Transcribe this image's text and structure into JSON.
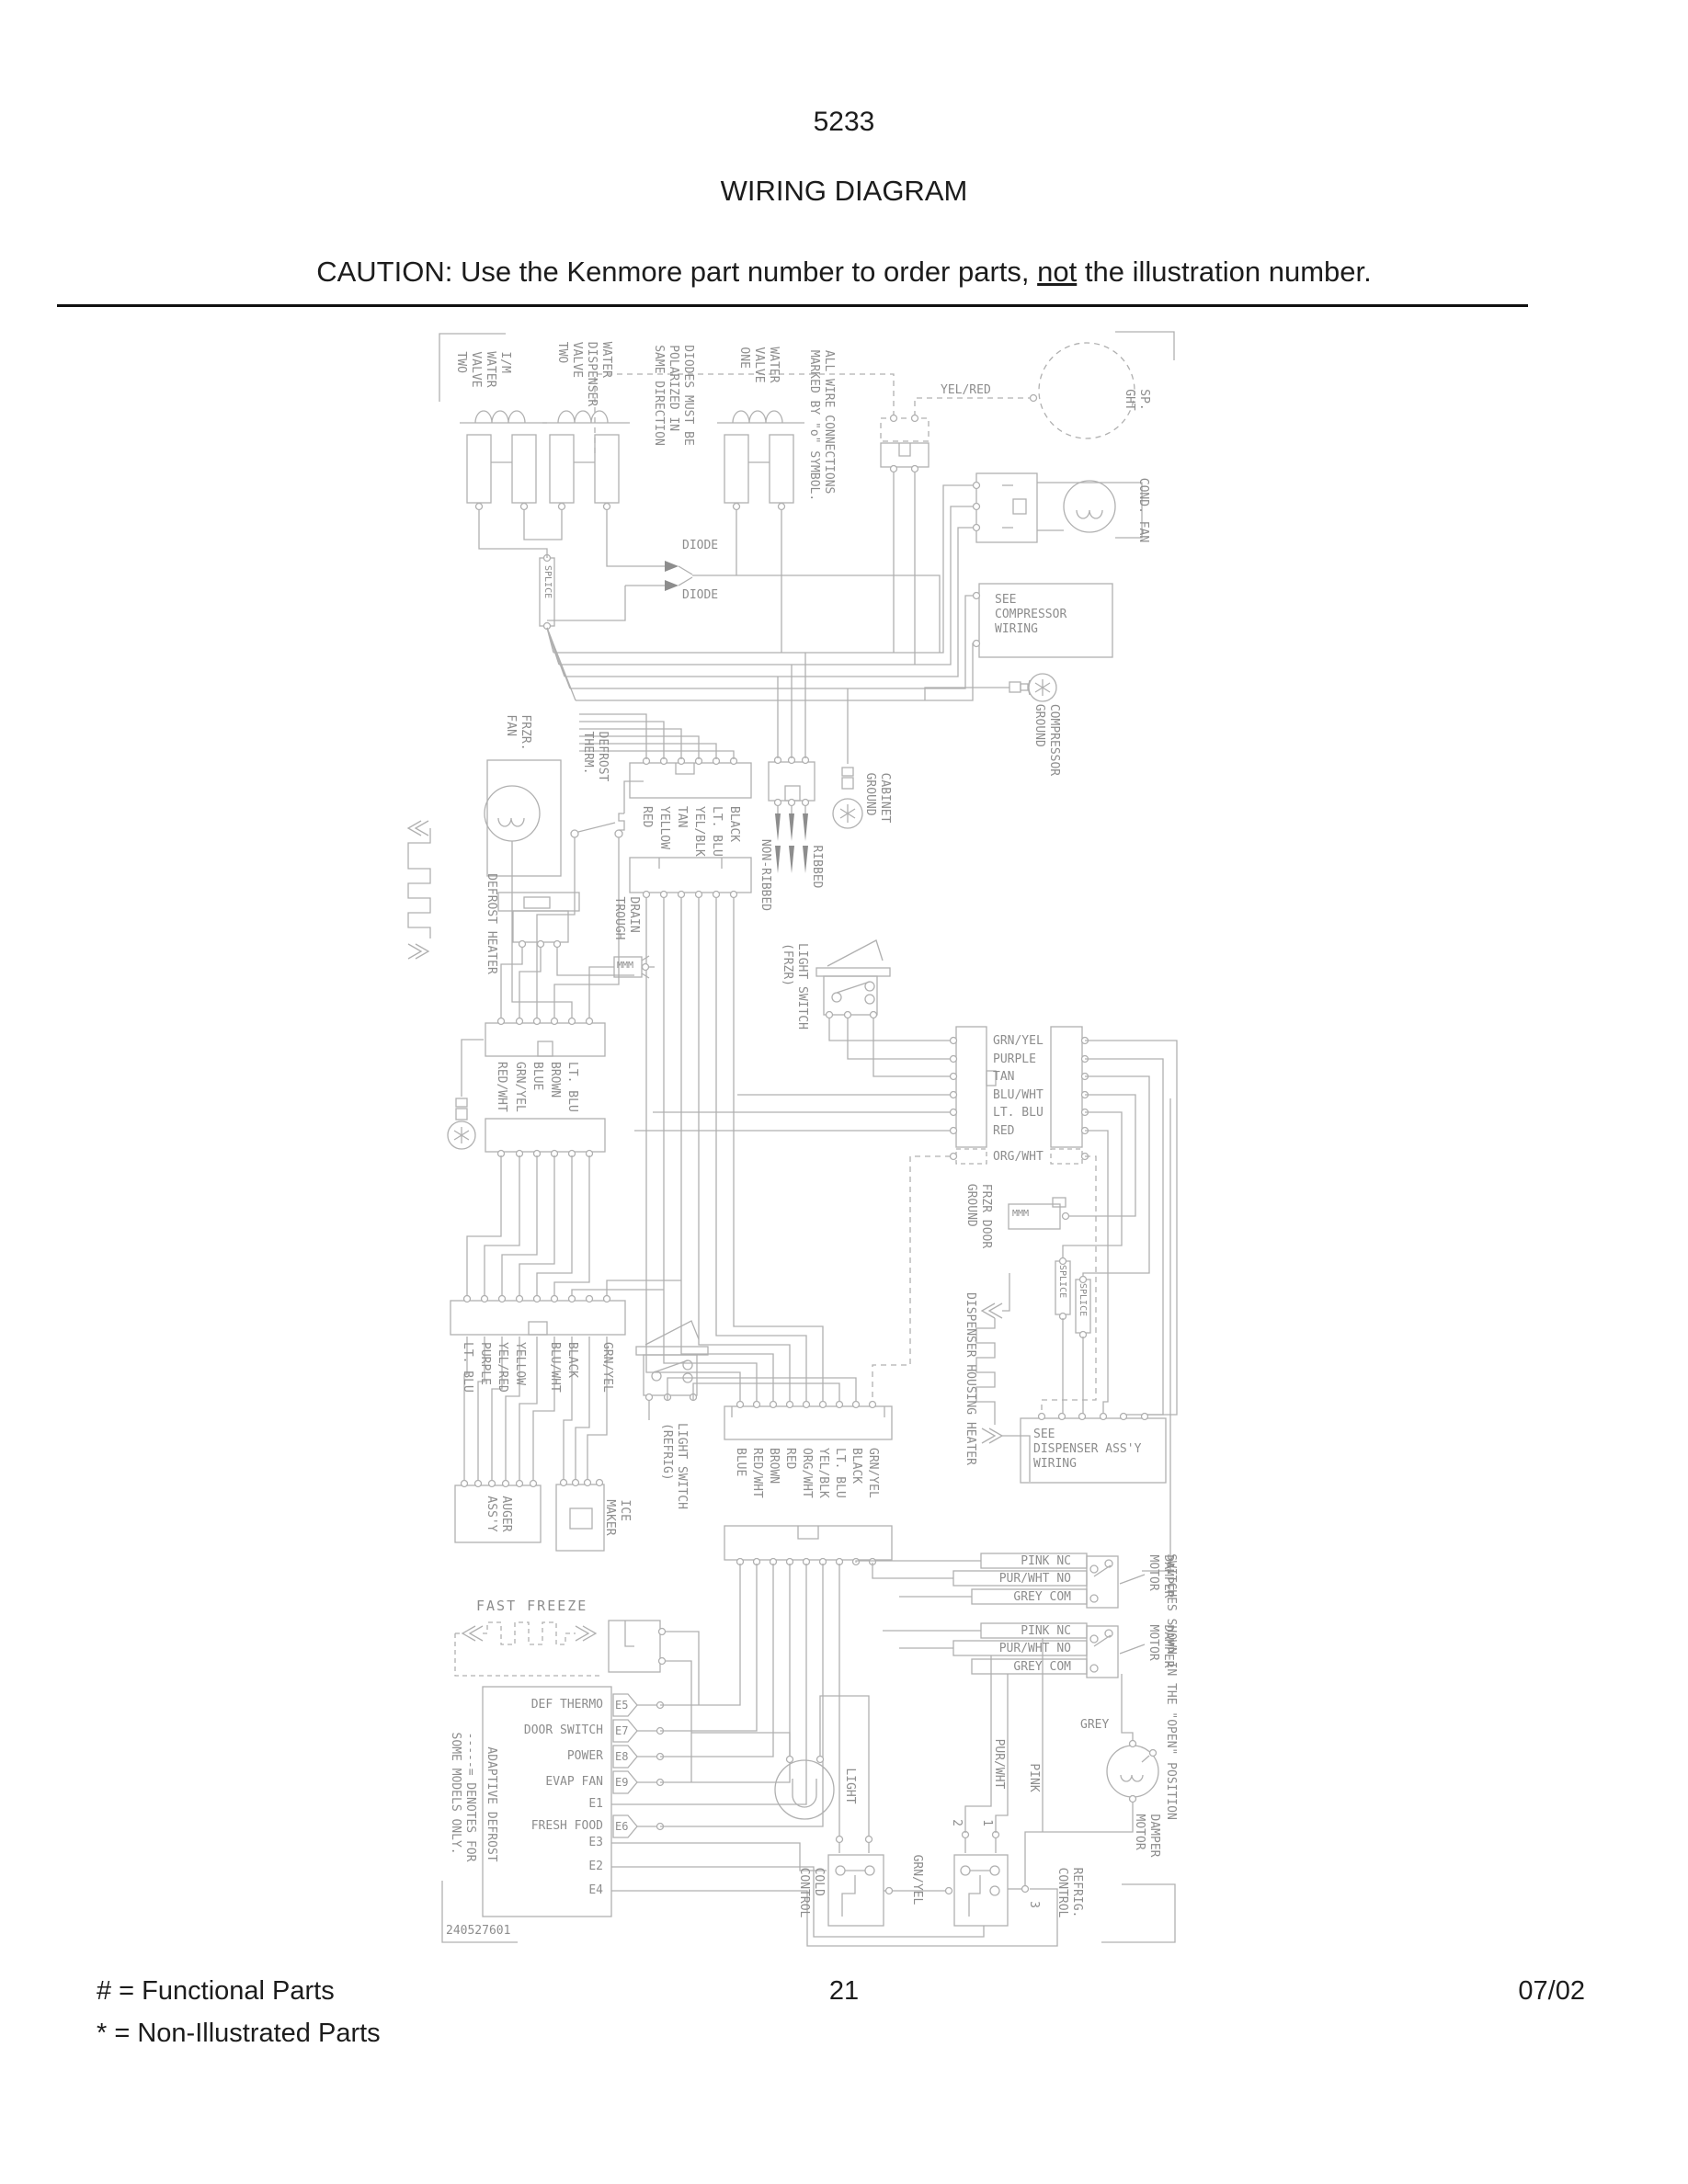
{
  "header": {
    "code": "5233",
    "title": "WIRING DIAGRAM",
    "caution_1": "CAUTION: Use the Kenmore part number to order parts, ",
    "caution_2": "not",
    "caution_3": " the illustration number."
  },
  "footer": {
    "legend_1": "#  =  Functional Parts",
    "legend_2": "*  =  Non-Illustrated Parts",
    "page": "21",
    "date": "07/02"
  },
  "d": {
    "im_valve": "I/M\nWATER\nVALVE\nTWO",
    "disp_valve": "WATER\nDISPENSER\nVALVE\nTWO",
    "diodes_note": "DIODES MUST BE\nPOLARIZED IN\nSAME DIRECTION",
    "valve_one": "WATER\nVALVE\nONE",
    "wire_note": "ALL WIRE CONNECTIONS\nMARKED BY \"o\" SYMBOL.",
    "splice": "SPLICE",
    "diode": "DIODE",
    "yel_red": "YEL/RED",
    "disp_light": "SP.\nGHT",
    "cond_fan": "COND. FAN",
    "see_compressor": "SEE\nCOMPRESSOR\nWIRING",
    "compressor_ground": "COMPRESSOR\nGROUND",
    "cabinet_ground": "CABINET\nGROUND",
    "frzr_fan": "FRZR.\nFAN",
    "defrost_therm": "DEFROST\nTHERM.",
    "conn_a": [
      "RED",
      "YELLOW",
      "TAN",
      "YEL/BLK",
      "LT. BLU",
      "BLACK"
    ],
    "non_ribbed": "NON-RIBBED",
    "ribbed": "RIBBED",
    "drain_trough": "DRAIN\nTROUGH",
    "defrost_heater": "DEFROST HEATER",
    "ls_frzr": "LIGHT SWITCH\n(FRZR)",
    "conn_b": [
      "RED/WHT",
      "GRN/YEL",
      "BLUE",
      "BROWN",
      "LT. BLU"
    ],
    "conn_c": [
      "GRN/YEL",
      "PURPLE",
      "TAN",
      "BLU/WHT",
      "LT. BLU",
      "RED",
      "ORG/WHT"
    ],
    "frzr_door_ground": "FRZR DOOR\nGROUND",
    "dispenser_heater": "DISPENSER HOUSING HEATER",
    "see_dispenser": "SEE\nDISPENSER ASS'Y\nWIRING",
    "conn_d": [
      "LT. BLU",
      "PURPLE",
      "YEL/RED",
      "YELLOW",
      "BLU/WHT",
      "BLACK",
      "GRN/YEL"
    ],
    "auger": "AUGER\nASS'Y",
    "ice_maker": "ICE\nMAKER",
    "ls_refrig": "LIGHT SWITCH\n(REFRIG)",
    "conn_e": [
      "BLUE",
      "RED/WHT",
      "BROWN",
      "RED",
      "ORG/WHT",
      "YEL/BLK",
      "LT. BLU",
      "BLACK",
      "GRN/YEL"
    ],
    "fast_freeze": "FAST FREEZE",
    "board": {
      "title": "ADAPTIVE DEFROST",
      "rows": [
        {
          "label": "DEF THERMO",
          "term": "E5"
        },
        {
          "label": "DOOR SWITCH",
          "term": "E7"
        },
        {
          "label": "POWER",
          "term": "E8"
        },
        {
          "label": "EVAP FAN",
          "term": "E9"
        },
        {
          "label": "E1",
          "term": ""
        },
        {
          "label": "FRESH FOOD",
          "term": "E6"
        },
        {
          "label": "E3",
          "term": ""
        },
        {
          "label": "E2",
          "term": ""
        },
        {
          "label": "E4",
          "term": ""
        }
      ]
    },
    "denotes_note": "-----= DENOTES FOR\nSOME MODELS ONLY.",
    "part_no": "240527601",
    "light": "LIGHT",
    "cold_control": "COLD\nCONTROL",
    "grn_yel": "GRN/YEL",
    "refrig_control": "REFRIG.\nCONTROL",
    "term_1": "1",
    "term_2": "2",
    "term_3": "3",
    "sw_rows": [
      "PINK NC",
      "PUR/WHT NO",
      "GREY COM"
    ],
    "damper_motor": "DAMPER\nMOTOR",
    "switches_note": "SWITCHES SHOWN IN THE \"OPEN\" POSITION",
    "grey": "GREY",
    "pur_wht": "PUR/WHT",
    "pink": "PINK",
    "resistor": "MMM"
  }
}
